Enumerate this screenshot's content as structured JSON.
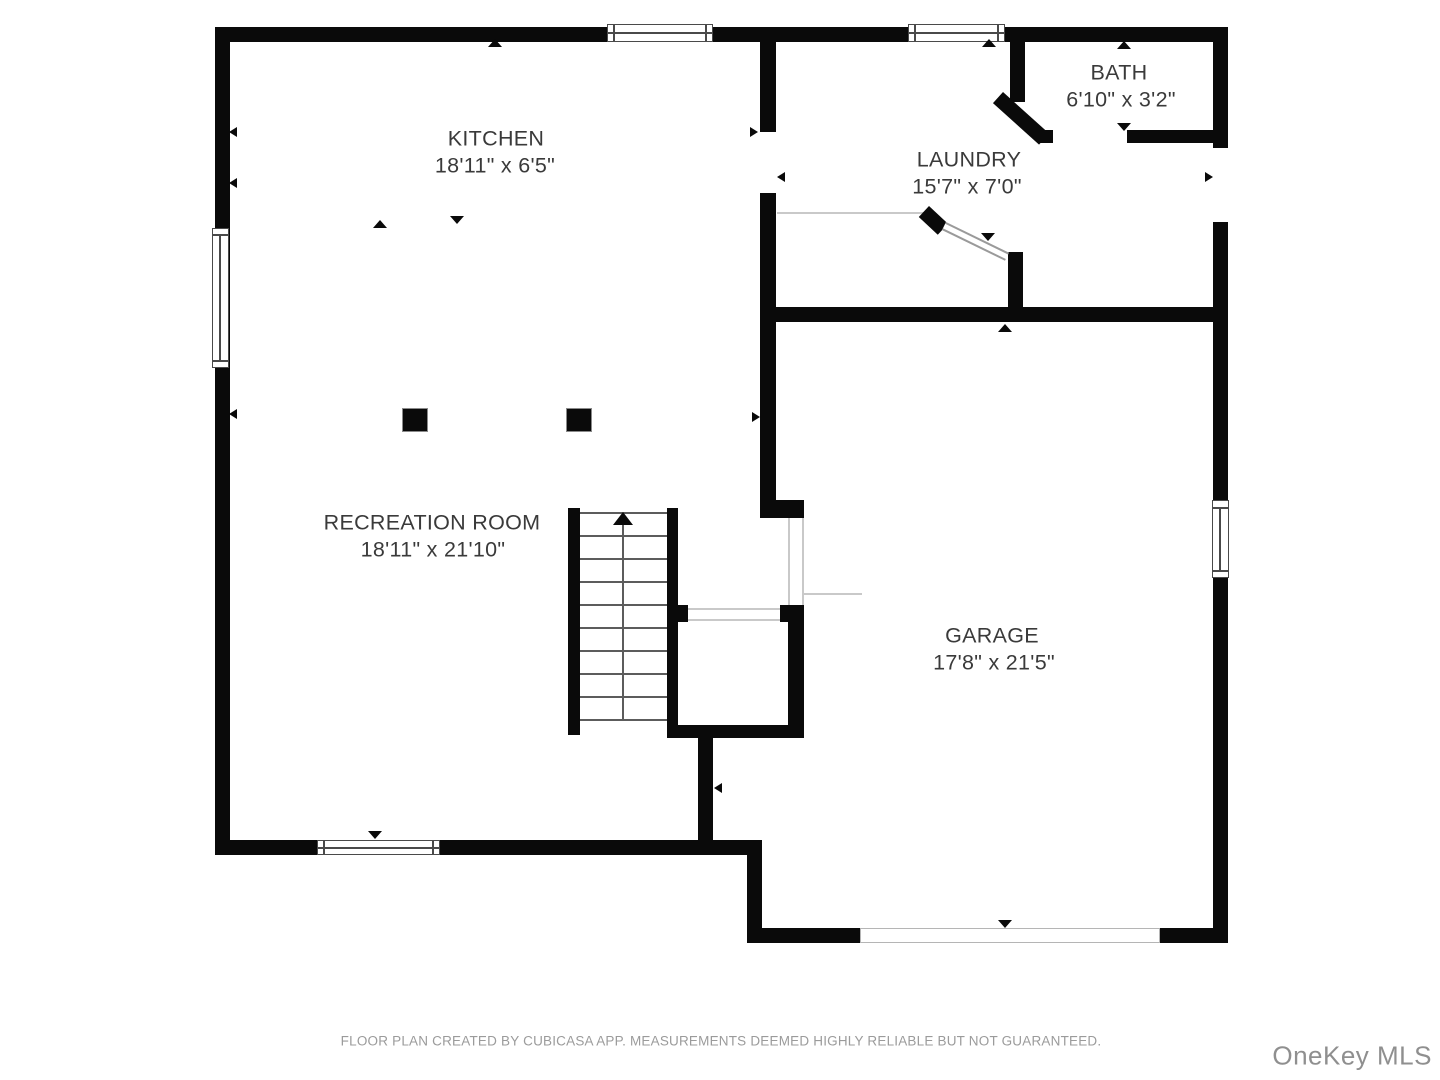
{
  "plan": {
    "rooms": [
      {
        "id": "kitchen",
        "name": "KITCHEN",
        "dims": "18'11\" x 6'5\""
      },
      {
        "id": "bath",
        "name": "BATH",
        "dims": "6'10\" x 3'2\""
      },
      {
        "id": "laundry",
        "name": "LAUNDRY",
        "dims": "15'7\" x 7'0\""
      },
      {
        "id": "recreation",
        "name": "RECREATION ROOM",
        "dims": "18'11\" x 21'10\""
      },
      {
        "id": "garage",
        "name": "GARAGE",
        "dims": "17'8\" x 21'5\""
      }
    ],
    "footer": "FLOOR PLAN CREATED BY CUBICASA APP. MEASUREMENTS DEEMED HIGHLY RELIABLE BUT NOT GUARANTEED.",
    "watermark": "OneKey MLS",
    "colors": {
      "wall": "#0a0a0a",
      "label": "#3a3a3a",
      "footer": "#9b9b9b",
      "watermark": "#8f8f8f",
      "bg": "#ffffff"
    }
  }
}
